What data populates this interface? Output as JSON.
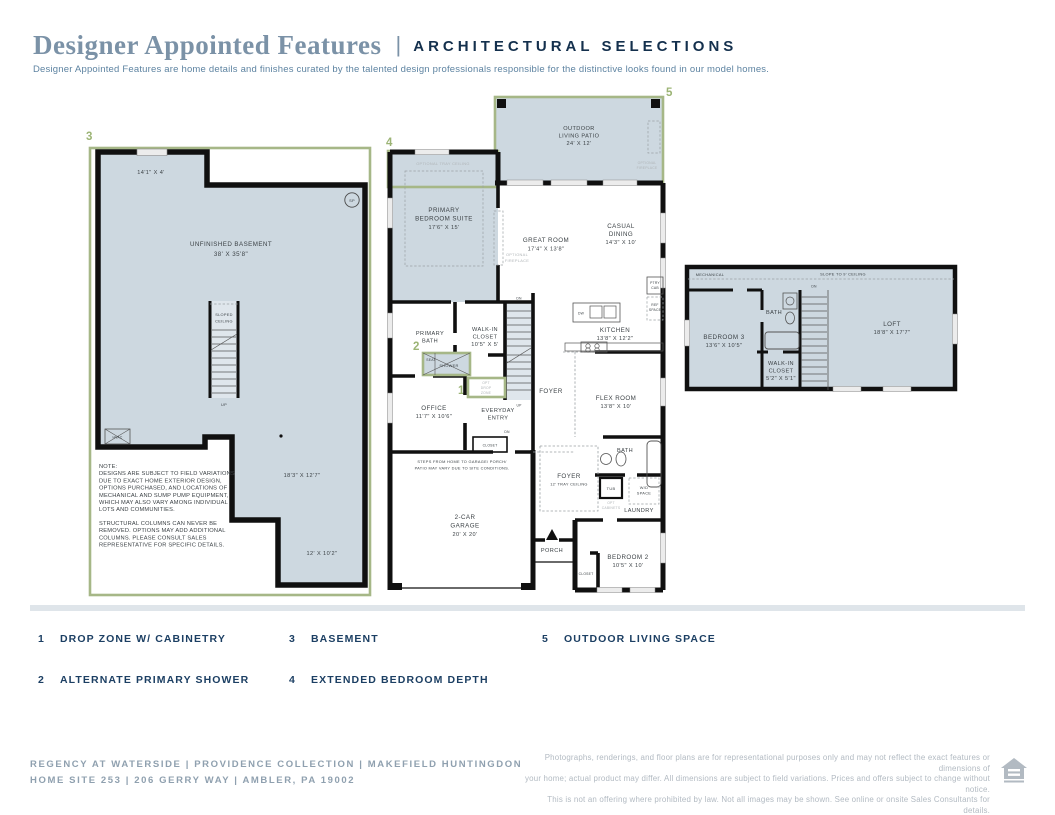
{
  "header": {
    "title": "Designer Appointed Features",
    "pipe": "|",
    "section": "ARCHITECTURAL SELECTIONS",
    "tagline": "Designer Appointed Features are home details and finishes curated by the talented design professionals responsible for the distinctive looks found in our model homes."
  },
  "colors": {
    "accent_green": "#a6b787",
    "marker_green": "#9cb475",
    "room_fill": "#cdd8e0",
    "legend_navy": "#1c3f63",
    "title_slate": "#7b92a7",
    "wall_black": "#101010"
  },
  "plans": {
    "basement": {
      "dim_top": "14'1\" X 4'",
      "sp": "SP",
      "room": "UNFINISHED BASEMENT",
      "room_dim": "38' X 35'8\"",
      "sloped1": "SLOPED",
      "sloped2": "CEILING",
      "up": "UP",
      "hvac": "HVAC",
      "dim_mid": "18'3\" X 12'7\"",
      "dim_low": "12' X 10'2\"",
      "note": [
        "NOTE:",
        "DESIGNS ARE SUBJECT TO FIELD VARIATIONS",
        "DUE TO EXACT HOME EXTERIOR DESIGN,",
        "OPTIONS PURCHASED, AND LOCATIONS OF",
        "MECHANICAL AND SUMP PUMP EQUIPMENT,",
        "WHICH MAY ALSO VARY AMONG INDIVIDUAL",
        "LOTS AND COMMUNITIES.",
        "STRUCTURAL COLUMNS CAN NEVER BE",
        "REMOVED. OPTIONS MAY ADD ADDITIONAL",
        "COLUMNS. PLEASE CONSULT SALES",
        "REPRESENTATIVE FOR SPECIFIC DETAILS."
      ]
    },
    "main": {
      "patio": {
        "l1": "OUTDOOR",
        "l2": "LIVING PATIO",
        "l3": "24' X 12'"
      },
      "patio_fireplace": {
        "l1": "OPTIONAL",
        "l2": "FIREPLACE"
      },
      "tray": "OPTIONAL TRAY CEILING",
      "primary_suite": {
        "l1": "PRIMARY",
        "l2": "BEDROOM SUITE",
        "l3": "17'6\" X 15'"
      },
      "great_room": {
        "l1": "GREAT ROOM",
        "l2": "17'4\" X 13'8\""
      },
      "opt_fireplace": {
        "l1": "OPTIONAL",
        "l2": "FIREPLACE"
      },
      "casual_dining": {
        "l1": "CASUAL",
        "l2": "DINING",
        "l3": "14'3\" X 10'"
      },
      "kitchen": {
        "l1": "KITCHEN",
        "l2": "13'8\" X 12'2\""
      },
      "dw": "DW",
      "ptry": {
        "l1": "PTRY",
        "l2": "CAB"
      },
      "ref": {
        "l1": "REF",
        "l2": "SPACE"
      },
      "primary_bath": {
        "l1": "PRIMARY",
        "l2": "BATH"
      },
      "wic": {
        "l1": "WALK-IN",
        "l2": "CLOSET",
        "l3": "10'5\" X 5'"
      },
      "seat": "SEAT",
      "shower": "SHOWER",
      "dn_stairs": "DN",
      "up": "UP",
      "opt_drop": {
        "l1": "OPT",
        "l2": "DROP",
        "l3": "ZONE"
      },
      "foyer_upper": "FOYER",
      "office": {
        "l1": "OFFICE",
        "l2": "11'7\" X 10'6\""
      },
      "everyday": {
        "l1": "EVERYDAY",
        "l2": "ENTRY"
      },
      "dn_entry": "DN",
      "closet_entry": "CLOSET",
      "flex": {
        "l1": "FLEX ROOM",
        "l2": "13'8\" X 10'"
      },
      "bath2": "BATH",
      "tub": "TUB",
      "opt_cab": {
        "l1": "OPT",
        "l2": "CABINETS"
      },
      "wd": {
        "l1": "W/D",
        "l2": "SPACE"
      },
      "laundry": "LAUNDRY",
      "foyer_main": {
        "l1": "FOYER",
        "l2": "12' TRAY CEILING"
      },
      "steps": {
        "l1": "STEPS FROM HOME TO GARAGE/ PORCH/",
        "l2": "PATIO MAY VARY DUE TO SITE CONDITIONS."
      },
      "garage": {
        "l1": "2-CAR",
        "l2": "GARAGE",
        "l3": "20' X 20'"
      },
      "porch": "PORCH",
      "bedroom2": {
        "l1": "BEDROOM 2",
        "l2": "10'5\" X 10'"
      },
      "closet_b2": "CLOSET"
    },
    "upper": {
      "mechanical": "MECHANICAL",
      "slope": "SLOPE TO 9' CEILING",
      "dn": "DN",
      "bedroom3": {
        "l1": "BEDROOM 3",
        "l2": "13'6\" X 10'5\""
      },
      "bath": "BATH",
      "loft": {
        "l1": "LOFT",
        "l2": "18'8\" X 17'7\""
      },
      "wic": {
        "l1": "WALK-IN",
        "l2": "CLOSET",
        "l3": "5'2\" X 5'1\""
      }
    }
  },
  "legend": {
    "items": [
      {
        "num": "1",
        "label": "DROP ZONE W/ CABINETRY"
      },
      {
        "num": "2",
        "label": "ALTERNATE PRIMARY SHOWER"
      },
      {
        "num": "3",
        "label": "BASEMENT"
      },
      {
        "num": "4",
        "label": "EXTENDED BEDROOM DEPTH"
      },
      {
        "num": "5",
        "label": "OUTDOOR LIVING SPACE"
      }
    ]
  },
  "footer": {
    "line1": "REGENCY AT WATERSIDE  |  PROVIDENCE COLLECTION  |  MAKEFIELD HUNTINGDON",
    "line2": "HOME SITE 253  |  206 GERRY WAY  |  AMBLER, PA 19002",
    "disclaimer1": "Photographs, renderings, and floor plans are for representational purposes only and may not reflect the exact features or dimensions of",
    "disclaimer2": "your home; actual product may differ. All dimensions are subject to field variations. Prices and offers subject to change without notice.",
    "disclaimer3": "This is not an offering where prohibited by law. Not all images may be shown. See online or onsite Sales Consultants for details."
  }
}
